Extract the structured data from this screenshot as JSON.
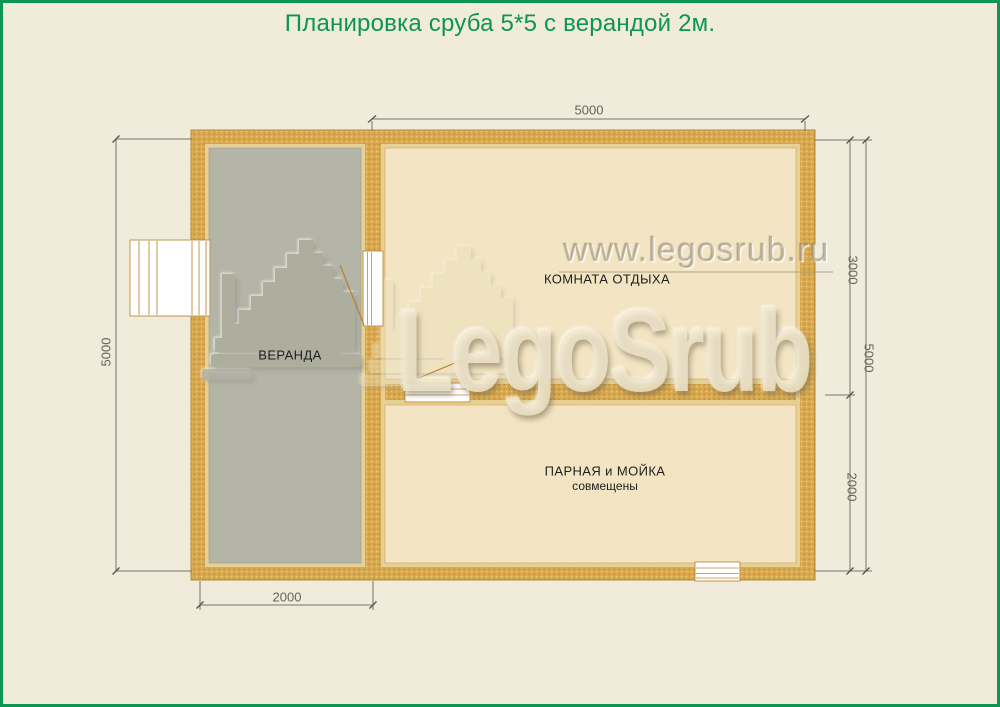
{
  "page": {
    "title": "Планировка сруба 5*5 с верандой 2м."
  },
  "plan": {
    "rooms": [
      {
        "label": "ВЕРАНДА"
      },
      {
        "label": "КОМНАТА ОТДЫХА"
      },
      {
        "label": "ПАРНАЯ и МОЙКА",
        "sublabel": "совмещены"
      }
    ],
    "dimensions": {
      "top_width": "5000",
      "left_height": "5000",
      "veranda_width": "2000",
      "right_room_top": "3000",
      "right_room_bottom": "2000",
      "right_total": "5000"
    }
  },
  "watermark": {
    "site": "www.legosrub.ru",
    "brand": "LegoSrub"
  },
  "colors": {
    "accent_green": "#0d9552",
    "wall_fill": "#d8a94f",
    "wall_lining": "#e7d095",
    "veranda_floor": "#b5b5a7",
    "room_floor": "#f3e5c3",
    "dimension_line": "#76766b"
  }
}
